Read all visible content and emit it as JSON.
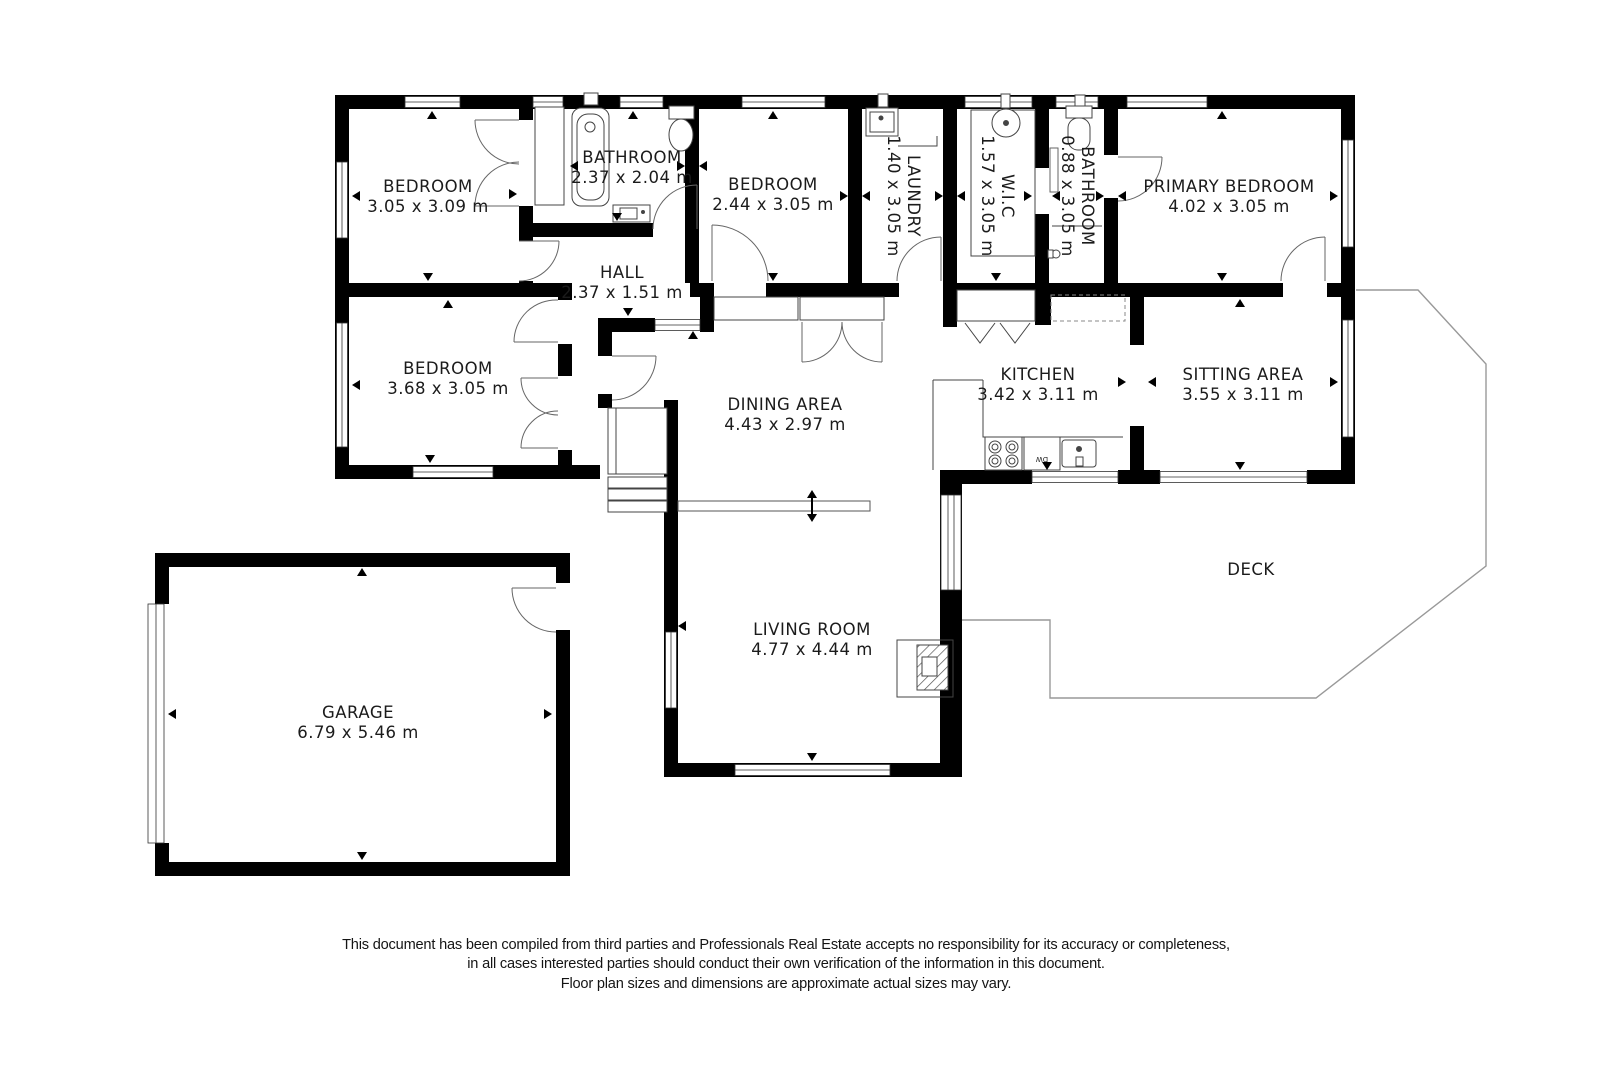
{
  "rooms": {
    "bedroom1": {
      "name": "BEDROOM",
      "dims": "3.05 x 3.09 m"
    },
    "bathroom1": {
      "name": "BATHROOM",
      "dims": "2.37 x 2.04 m"
    },
    "bedroom2": {
      "name": "BEDROOM",
      "dims": "2.44 x 3.05 m"
    },
    "laundry": {
      "name": "LAUNDRY",
      "dims": "1.40 x 3.05 m"
    },
    "wic": {
      "name": "W.I.C",
      "dims": "1.57 x 3.05 m"
    },
    "bathroom2": {
      "name": "BATHROOM",
      "dims": "0.88 x 3.05 m"
    },
    "primary": {
      "name": "PRIMARY BEDROOM",
      "dims": "4.02 x 3.05 m"
    },
    "hall": {
      "name": "HALL",
      "dims": "2.37 x 1.51 m"
    },
    "bedroom3": {
      "name": "BEDROOM",
      "dims": "3.68 x 3.05 m"
    },
    "dining": {
      "name": "DINING AREA",
      "dims": "4.43 x 2.97 m"
    },
    "kitchen": {
      "name": "KITCHEN",
      "dims": "3.42 x 3.11 m"
    },
    "sitting": {
      "name": "SITTING AREA",
      "dims": "3.55 x 3.11 m"
    },
    "living": {
      "name": "LIVING ROOM",
      "dims": "4.77 x 4.44 m"
    },
    "deck": {
      "name": "DECK"
    },
    "garage": {
      "name": "GARAGE",
      "dims": "6.79 x 5.46 m"
    }
  },
  "fixtures": {
    "dishwasher": "DW"
  },
  "disclaimer": {
    "line1": "This document has been compiled from third parties and Professionals Real Estate accepts no responsibility for its accuracy or completeness,",
    "line2": "in all cases interested parties should conduct their own verification of the information in this document.",
    "line3": "Floor plan sizes and dimensions are approximate actual sizes may vary."
  },
  "colors": {
    "wall": "#000000",
    "fixture_line": "#444444",
    "deck_outline": "#999999",
    "text": "#1b1b1b"
  }
}
